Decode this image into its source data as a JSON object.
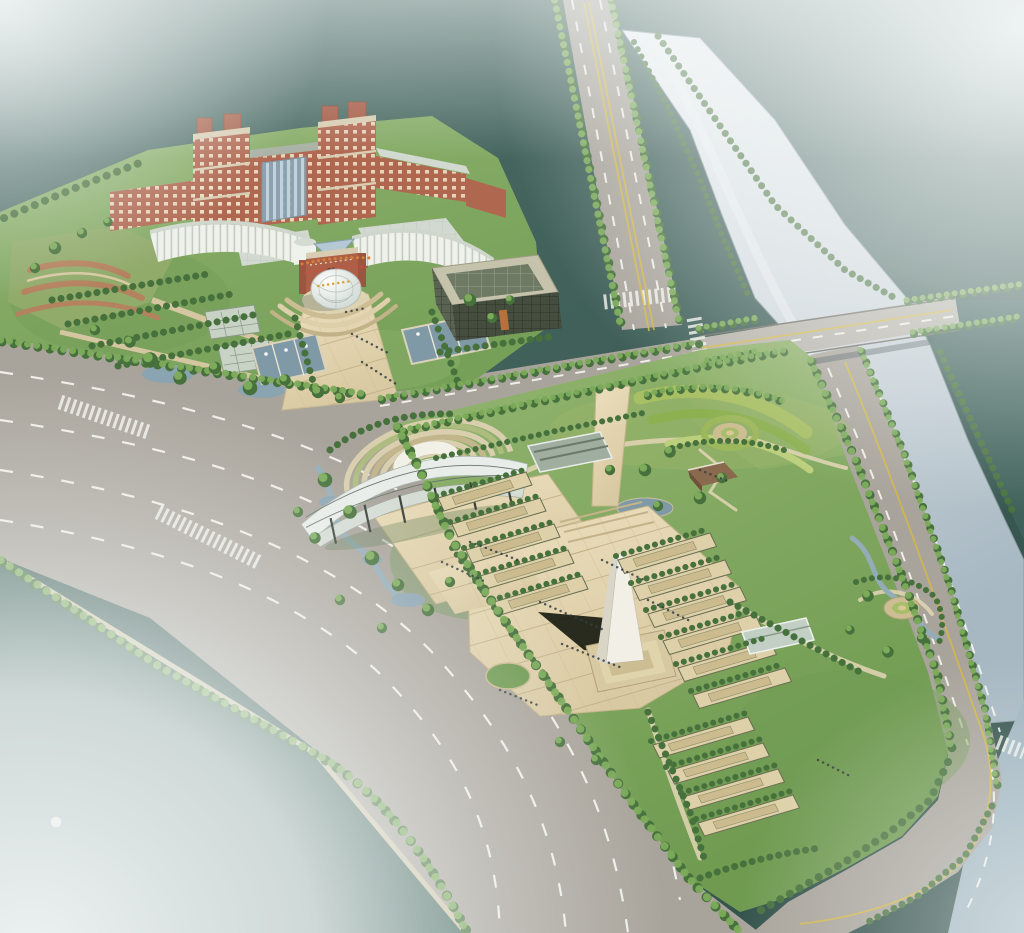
{
  "scene": {
    "type": "architectural-aerial-rendering",
    "description": "Bird's-eye master-plan rendering of a riverside civic campus: red-brick twin-tower complex with curved white podium wings and a glass dome plaza, a dark gridded annex block, orchard gardens, greenhouses and fountain pools; across a tree-lined avenue a landscaped memorial park with a fan-shaped amphitheatre under a ribbed canopy, a white obelisk on a stepped plinth casting a long shadow, terraced planting beds, circular flower rings, a pavilion, ponds and winding streams; a river crossed by a road bridge runs along the right, wide boulevards with lane markings and street trees frame the site, and white haze fades the corners of the view",
    "landmarks": [
      "main-tower-complex",
      "curved-podium-wings",
      "entrance-gateway",
      "glass-dome",
      "annex-grid-building",
      "fountain-pools",
      "campus-greenhouses",
      "orchard-gardens",
      "brick-terrace-garden",
      "amphitheatre",
      "canopy-stage",
      "obelisk-monument",
      "memorial-plaza",
      "terraced-flower-beds",
      "flower-ring-north",
      "flower-ring-east",
      "garden-pavilion",
      "park-greenhouses",
      "ponds-and-streams",
      "river",
      "road-bridge",
      "north-avenue",
      "grand-boulevard",
      "riverside-road",
      "street-trees",
      "pedestrians"
    ]
  },
  "palette": {
    "water_light": "#5a7872",
    "water_mid": "#44645d",
    "water_deep": "#3a5a53",
    "water_deepest": "#33514b",
    "river_light": "#f0f3f4",
    "river_mid": "#cfd7dc",
    "river_low": "#a7b8c2",
    "water_wedge": "#9fb4bf",
    "fog": "#f3f7f7",
    "road": "#a9a49b",
    "road_light": "#b7b3aa",
    "lane_white": "#f5f5ef",
    "lane_yellow": "#d6b844",
    "plaza_light": "#ecdfbd",
    "plaza_dark": "#d9c9a2",
    "plaza_band": "#b6a379",
    "grass_campus": "#8fb26e",
    "grass_campus_dark": "#76a058",
    "grass_park": "#93b570",
    "grass_park_dark": "#6f9a50",
    "tree_dark": "#47713c",
    "tree_light": "#7cab5a",
    "hedge": "#a8bf63",
    "sand": "#cfc5a8",
    "brick": "#b06750",
    "brick_dark": "#9c5540",
    "trim": "#d8cdb2",
    "glass": "#9db4c2",
    "white_wall": "#eff1eb",
    "roof": "#d2d9d0",
    "dark_facade": "#4d5547",
    "pool": "#7f99a6",
    "stream": "#94acb8",
    "dome": "#e8ece9",
    "obelisk": "#f2f0e6",
    "shadow": "#15180f",
    "figures": "#333c42",
    "flower_orange": "#d2803a",
    "flower_red": "#c05545",
    "path_tan": "#ded3b0"
  }
}
